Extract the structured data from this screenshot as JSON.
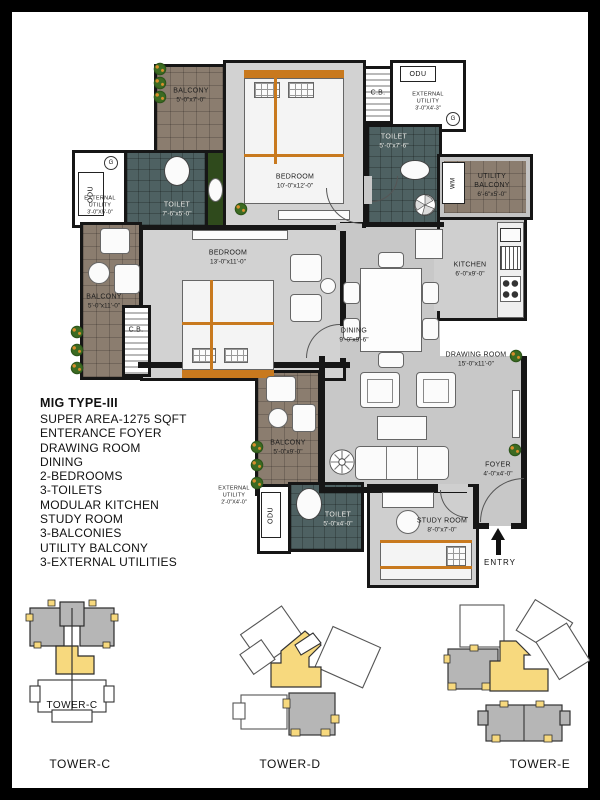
{
  "plan": {
    "rooms": {
      "balcony_tl": {
        "name": "BALCONY",
        "dims": "5'-0\"x7'-0\""
      },
      "ext_utility_tl": {
        "name": "EXTERNAL UTILITY",
        "dims": "3'-0\"X5'-0\""
      },
      "toilet_tl": {
        "name": "TOILET",
        "dims": "7'-6\"x5'-0\""
      },
      "bedroom_top": {
        "name": "BEDROOM",
        "dims": "10'-0\"x12'-0\""
      },
      "ext_utility_tr": {
        "name": "EXTERNAL UTILITY",
        "dims": "3'-0\"X4'-3\""
      },
      "toilet_tr": {
        "name": "TOILET",
        "dims": "5'-0\"x7'-6\""
      },
      "utility_balcony": {
        "name": "UTILITY BALCONY",
        "dims": "6'-6\"x5'-0\""
      },
      "kitchen": {
        "name": "KITCHEN",
        "dims": "6'-0\"x9'-0\""
      },
      "balcony_left": {
        "name": "BALCONY",
        "dims": "5'-0\"x11'-0\""
      },
      "bedroom_left": {
        "name": "BEDROOM",
        "dims": "13'-0\"x11'-0\""
      },
      "dining": {
        "name": "DINING",
        "dims": "9'-0\"x9'-6\""
      },
      "drawing_room": {
        "name": "DRAWING ROOM",
        "dims": "15'-0\"x11'-0\""
      },
      "balcony_bottom": {
        "name": "BALCONY",
        "dims": "5'-0\"x9'-0\""
      },
      "ext_utility_bot": {
        "name": "EXTERNAL UTILITY",
        "dims": "2'-0\"X4'-0\""
      },
      "toilet_bottom": {
        "name": "TOILET",
        "dims": "5'-0\"x4'-0\""
      },
      "study_room": {
        "name": "STUDY ROOM",
        "dims": "8'-0\"x7'-0\""
      },
      "foyer": {
        "name": "FOYER",
        "dims": "4'-0\"x4'-0\""
      }
    },
    "fixtures": {
      "odu": "ODU",
      "wm": "WM",
      "cb": "C.B.",
      "geyser": "G"
    },
    "entry_label": "ENTRY"
  },
  "legend": {
    "title": "MIG TYPE-III",
    "lines": [
      "SUPER AREA-1275 SQFT",
      "ENTERANCE FOYER",
      "DRAWING ROOM",
      "DINING",
      "2-BEDROOMS",
      "3-TOILETS",
      "MODULAR KITCHEN",
      "STUDY ROOM",
      "3-BALCONIES",
      "UTILITY BALCONY",
      "3-EXTERNAL UTILITIES"
    ]
  },
  "towers": [
    {
      "label": "TOWER-C",
      "inner_label": "TOWER-C"
    },
    {
      "label": "TOWER-D"
    },
    {
      "label": "TOWER-E"
    }
  ],
  "colors": {
    "balcony_tile": "#8b7d6f",
    "toilet_tile": "#4e6162",
    "floor_gray": "#c8c8c8",
    "wall": "#161616",
    "wood_accent": "#c8791e",
    "tower_highlight": "#f7d97e",
    "tower_gray": "#b6b6b6",
    "plant_green": "#3c6b22"
  }
}
